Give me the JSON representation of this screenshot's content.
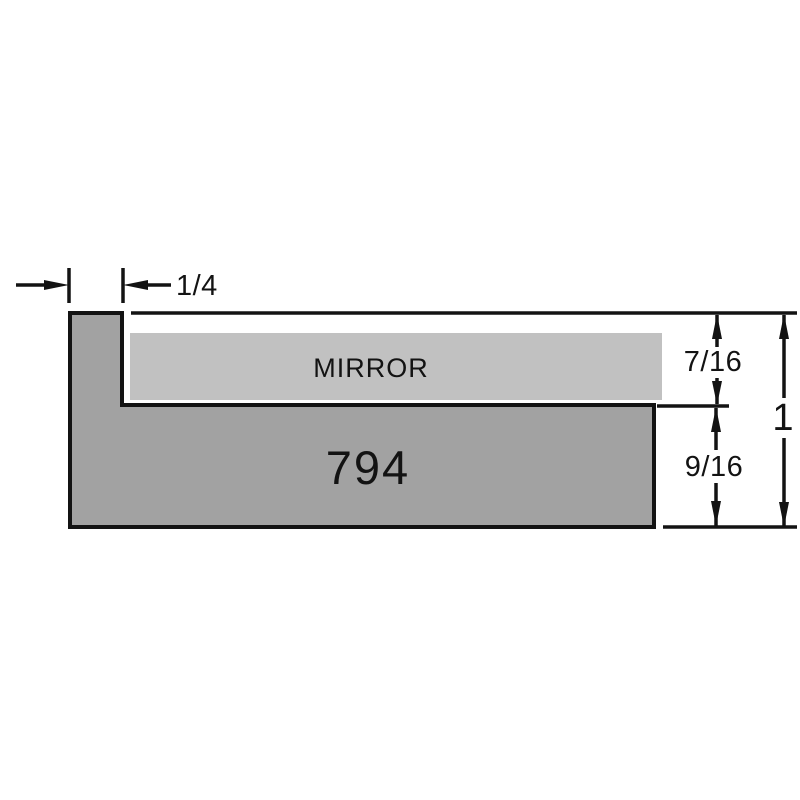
{
  "diagram": {
    "mirror_label": "MIRROR",
    "profile_number": "794",
    "dimensions": {
      "lip_width": "1/4",
      "rabbet_depth": "7/16",
      "base_height": "9/16",
      "overall_height": "1"
    },
    "colors": {
      "moulding_fill": "#a2a2a2",
      "mirror_fill": "#c1c1c1",
      "line_color": "#131313",
      "background": "#ffffff"
    }
  }
}
